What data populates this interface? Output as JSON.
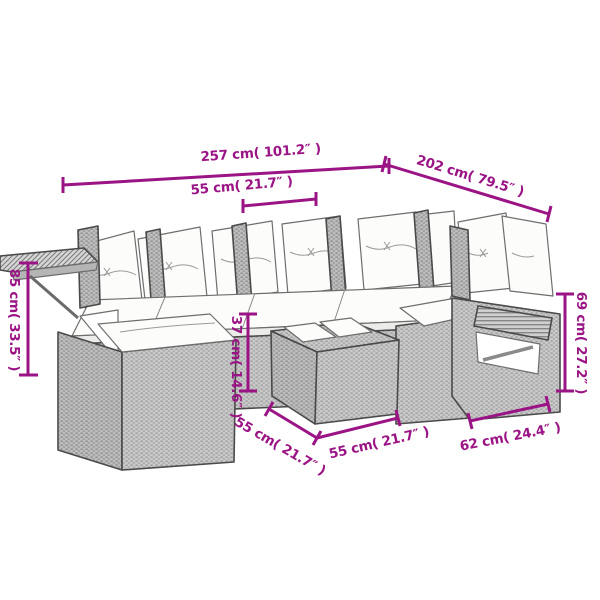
{
  "page": {
    "background": "#ffffff"
  },
  "diagram": {
    "kind": "furniture-dimension-diagram",
    "subject": "poly rattan corner garden sofa set with cushions and footstool",
    "accent_color": "#9B1485",
    "sofa_body_color": "#c9c9c9",
    "cushion_color": "#fcfcfa",
    "labels": {
      "overall_width": "257 cm( 101.2″ )",
      "overall_depth": "202 cm( 79.5″ )",
      "seat_width": "55 cm( 21.7″ )",
      "total_height": "85 cm( 33.5″ )",
      "side_height": "69 cm( 27.2″ )",
      "footstool_height": "37 cm( 14.6″ )",
      "footstool_depth": "55 cm( 21.7″ )",
      "footstool_width": "55 cm( 21.7″ )",
      "corner_depth": "62 cm( 24.4″ )"
    },
    "measurements": [
      {
        "name": "overall width",
        "cm": 257,
        "inches": 101.2
      },
      {
        "name": "overall depth",
        "cm": 202,
        "inches": 79.5
      },
      {
        "name": "seat width",
        "cm": 55,
        "inches": 21.7
      },
      {
        "name": "total height",
        "cm": 85,
        "inches": 33.5
      },
      {
        "name": "side height",
        "cm": 69,
        "inches": 27.2
      },
      {
        "name": "footstool height",
        "cm": 37,
        "inches": 14.6
      },
      {
        "name": "footstool depth",
        "cm": 55,
        "inches": 21.7
      },
      {
        "name": "footstool width",
        "cm": 55,
        "inches": 21.7
      },
      {
        "name": "corner depth",
        "cm": 62,
        "inches": 24.4
      }
    ]
  }
}
